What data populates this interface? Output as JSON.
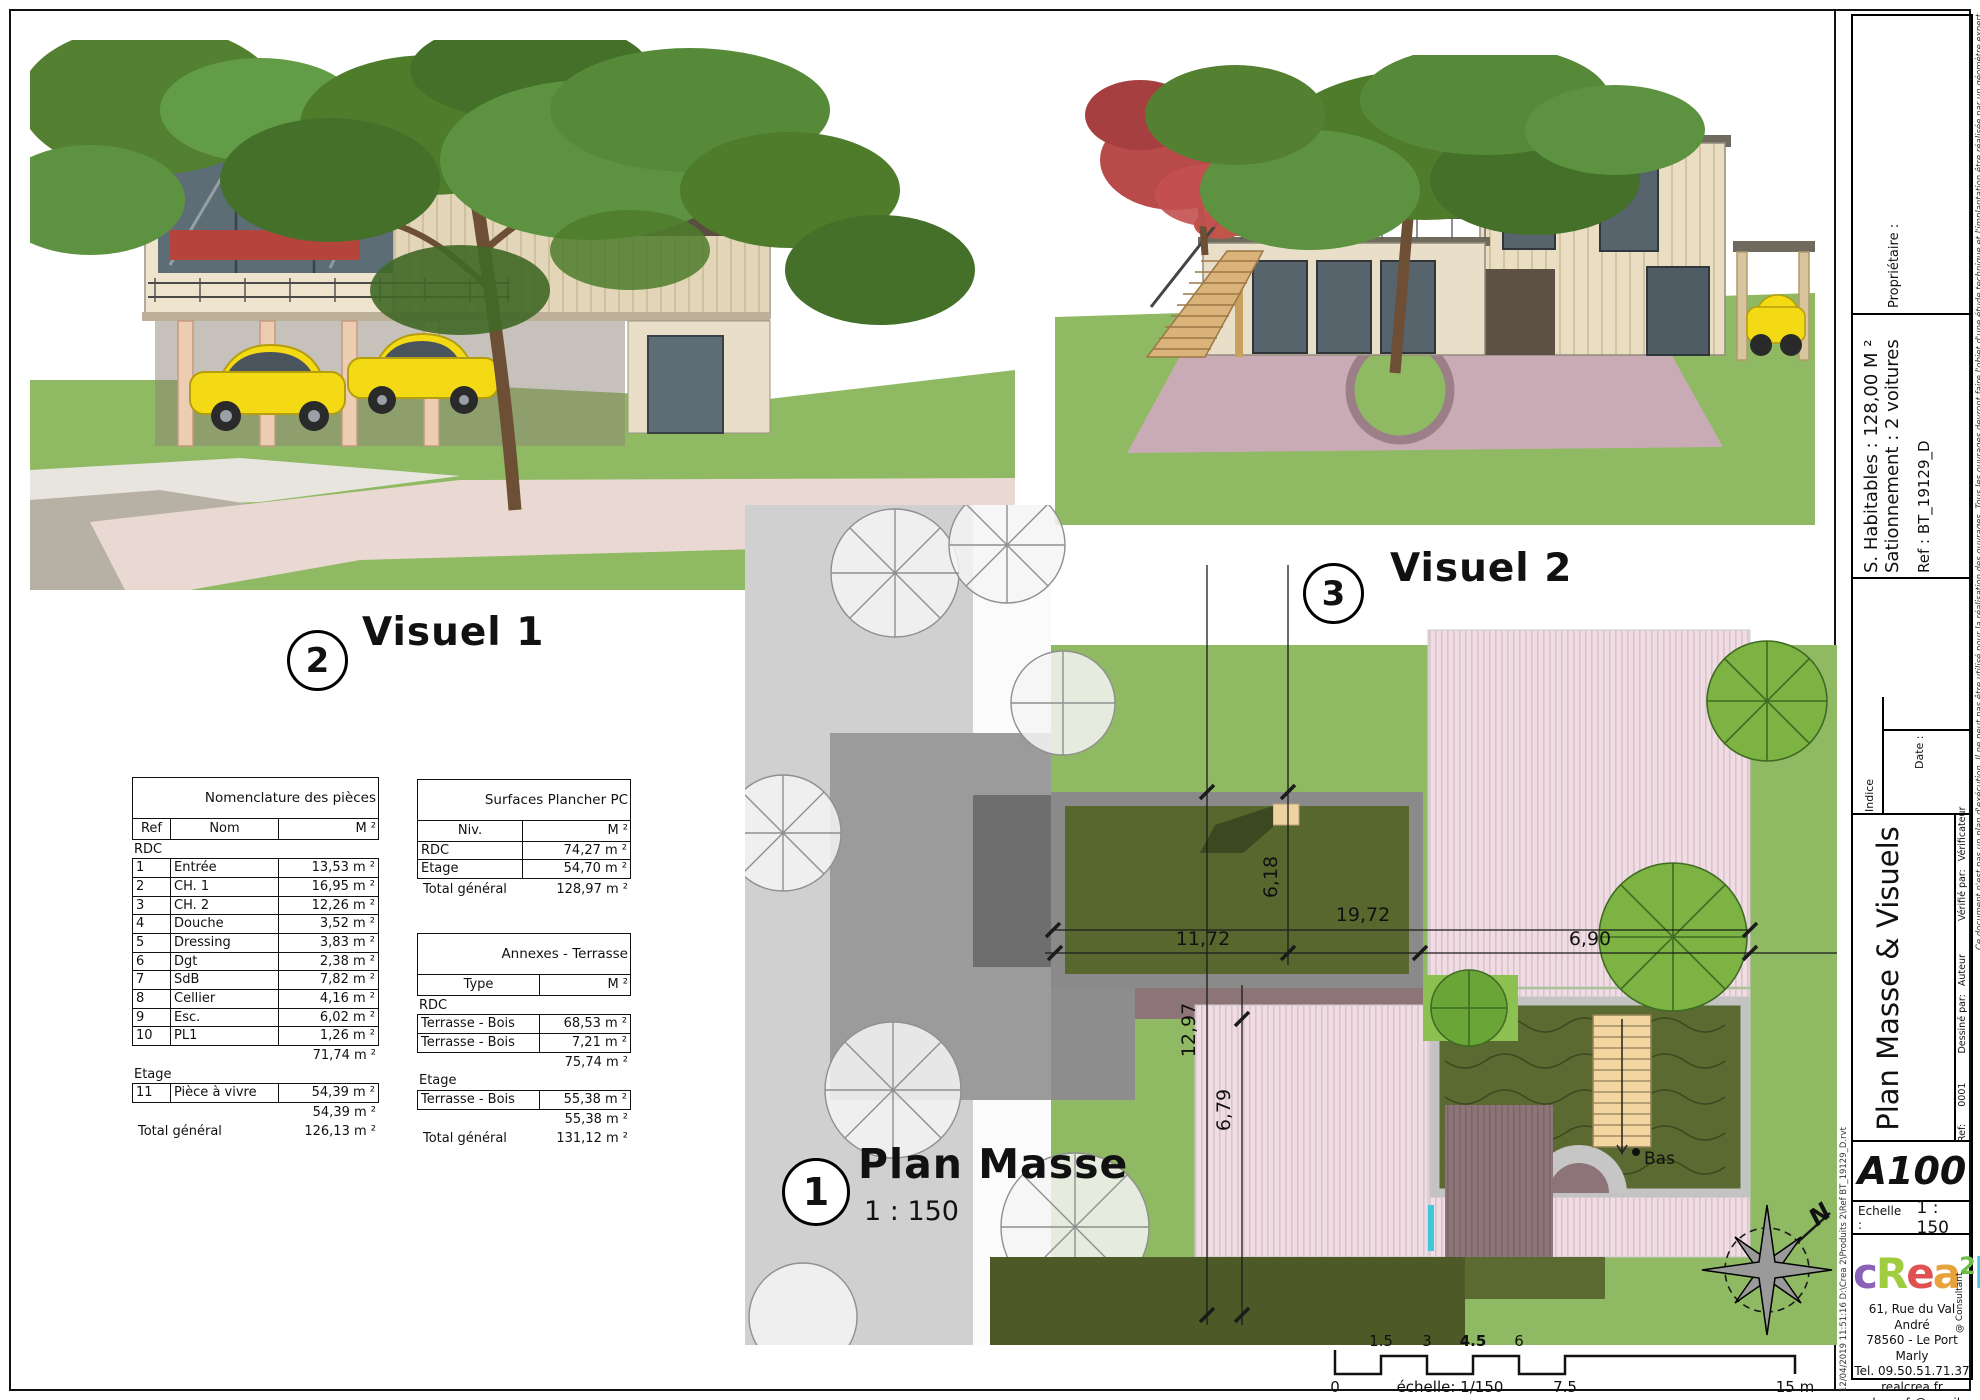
{
  "viewports": {
    "visuel1": {
      "number": "2",
      "label": "Visuel 1"
    },
    "visuel2": {
      "number": "3",
      "label": "Visuel 2"
    }
  },
  "plan": {
    "number": "1",
    "label": "Plan Masse",
    "scale": "1 : 150",
    "dims": {
      "d618": "6,18",
      "d1972": "19,72",
      "d1172": "11,72",
      "d1297": "12,97",
      "d679": "6,79",
      "d690": "6,90"
    },
    "bas": "Bas",
    "north": "N"
  },
  "tables": {
    "section_rdc": "RDC",
    "section_etage": "Etage",
    "total_label": "Total général",
    "nomenclature": {
      "title": "Nomenclature des pièces",
      "headers": [
        "Ref",
        "Nom",
        "M ²"
      ],
      "rdc_rows": [
        [
          "1",
          "Entrée",
          "13,53 m ²"
        ],
        [
          "2",
          "CH. 1",
          "16,95 m ²"
        ],
        [
          "3",
          "CH. 2",
          "12,26 m ²"
        ],
        [
          "4",
          "Douche",
          "3,52 m ²"
        ],
        [
          "5",
          "Dressing",
          "3,83 m ²"
        ],
        [
          "6",
          "Dgt",
          "2,38 m ²"
        ],
        [
          "7",
          "SdB",
          "7,82 m ²"
        ],
        [
          "8",
          "Cellier",
          "4,16 m ²"
        ],
        [
          "9",
          "Esc.",
          "6,02 m ²"
        ],
        [
          "10",
          "PL1",
          "1,26 m ²"
        ]
      ],
      "rdc_subtotal": "71,74 m ²",
      "etage_rows": [
        [
          "11",
          "Pièce à vivre",
          "54,39 m ²"
        ]
      ],
      "etage_subtotal": "54,39 m ²",
      "total": "126,13 m ²"
    },
    "surfaces": {
      "title": "Surfaces Plancher PC",
      "headers": [
        "Niv.",
        "M ²"
      ],
      "rows": [
        [
          "RDC",
          "74,27 m ²"
        ],
        [
          "Etage",
          "54,70 m ²"
        ]
      ],
      "total": "128,97 m ²"
    },
    "annexes": {
      "title": "Annexes - Terrasse",
      "headers": [
        "Type",
        "M ²"
      ],
      "rdc_rows": [
        [
          "Terrasse - Bois",
          "68,53 m ²"
        ],
        [
          "Terrasse - Bois",
          "7,21 m ²"
        ]
      ],
      "rdc_subtotal": "75,74 m ²",
      "etage_rows": [
        [
          "Terrasse - Bois",
          "55,38 m ²"
        ]
      ],
      "etage_subtotal": "55,38 m ²",
      "total": "131,12 m ²"
    }
  },
  "scalebar": {
    "top_labels": [
      "1.5",
      "3",
      "4.5",
      "6"
    ],
    "zero": "0",
    "caption": "échelle: 1/150",
    "mid": "7.5",
    "end": "15 m"
  },
  "titleblock": {
    "proprietaire": "Propriétaire :",
    "habitables": "S. Habitables : 128,00 M ²",
    "stationnement": "Sationnement : 2 voitures",
    "reference": "Ref : BT_19129_D",
    "indice": "Indice",
    "date": "Date :",
    "title": "Plan Masse & Visuels",
    "credits": {
      "ref_label": "Ref:",
      "num": "0001",
      "dessine_par": "Dessiné par:",
      "auteur": "Auteur",
      "verifie_par": "Vérifié par:",
      "verificateur": "Vérificateur"
    },
    "sheet_number": "A100",
    "echelle_label": "Echelle :",
    "echelle_value": "1 : 150",
    "logo": {
      "letters": [
        {
          "ch": "c",
          "color": "#8a63b8"
        },
        {
          "ch": "R",
          "color": "#a0cc3f"
        },
        {
          "ch": "e",
          "color": "#e05252"
        },
        {
          "ch": "a",
          "color": "#e8a23b"
        },
        {
          "ch": "2",
          "color": "#6cc04a"
        },
        {
          "ch": "l",
          "color": "#45c8e8"
        }
      ],
      "consultant": "@ Consultant"
    },
    "address": [
      "61, Rue du Val André",
      "78560 - Le Port Marly",
      "Tel. 09.50.51.71.37",
      "realcrea.fr",
      "realcrea.fr@gmail.com"
    ],
    "disclaimer": "Ce document n'est pas un plan d'exécution. Il ne peut pas être utilisé pour la réalisation des ouvrages. Tous les ouvrages devront faire l'objet d'une étude technique et l'implantation être réalisée par un géomètre expert.",
    "filepath": "12/04/2019 11:51:16   D:\\Crea 2\\Produits 2\\Ref BT_19129_D.rvt"
  },
  "colors": {
    "grass": "#8fb962",
    "roof_dark": "#57672e",
    "terrace_pink": "#f0dde3",
    "road_gray": "#d0d0d0"
  }
}
